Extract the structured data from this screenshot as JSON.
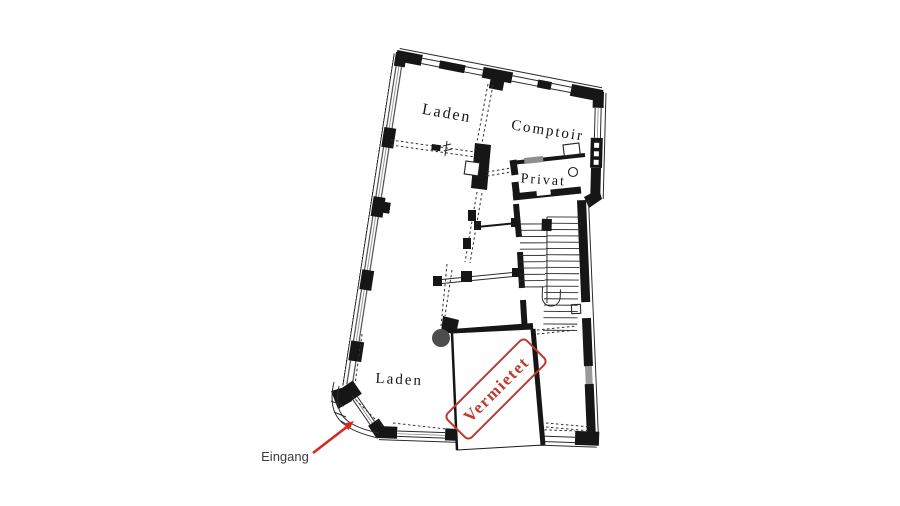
{
  "plan": {
    "background": "#ffffff",
    "ink": "#1a1a1a",
    "rooms": {
      "top_left": "Laden",
      "top_right": "Comptoir",
      "middle_right": "Privat",
      "bottom_left": "Laden"
    },
    "stamp": {
      "text": "Vermietet",
      "color": "#bf3a2f"
    },
    "entrance": {
      "label": "Eingang",
      "label_color": "#3c3c3c",
      "arrow_color": "#d6281e"
    }
  }
}
